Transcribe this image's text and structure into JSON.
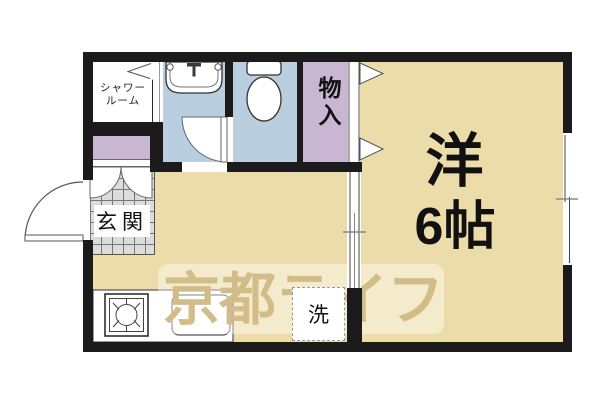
{
  "plan_type": "apartment-floorplan",
  "rooms": {
    "shower_room": {
      "label_line1": "シャワー",
      "label_line2": "ルーム"
    },
    "closet": {
      "label": "物入"
    },
    "western_room": {
      "type_label": "洋",
      "size_label": "6帖"
    },
    "entrance": {
      "label": "玄関"
    },
    "laundry": {
      "label": "洗"
    }
  },
  "watermark": {
    "text": "京都ライフ"
  },
  "fixtures": [
    "washbasin",
    "toilet",
    "stove",
    "kitchen-sink",
    "entrance-door",
    "window",
    "sliding-door",
    "closet-doors"
  ],
  "colors": {
    "wall": "#1b1b1b",
    "floor_tan": "#ecdcaa",
    "wet_room_blue": "#b9cede",
    "closet_purple": "#c9b6d2",
    "tile_gray": "#dcdcdc",
    "watermark_text": "#d2bd8a"
  }
}
